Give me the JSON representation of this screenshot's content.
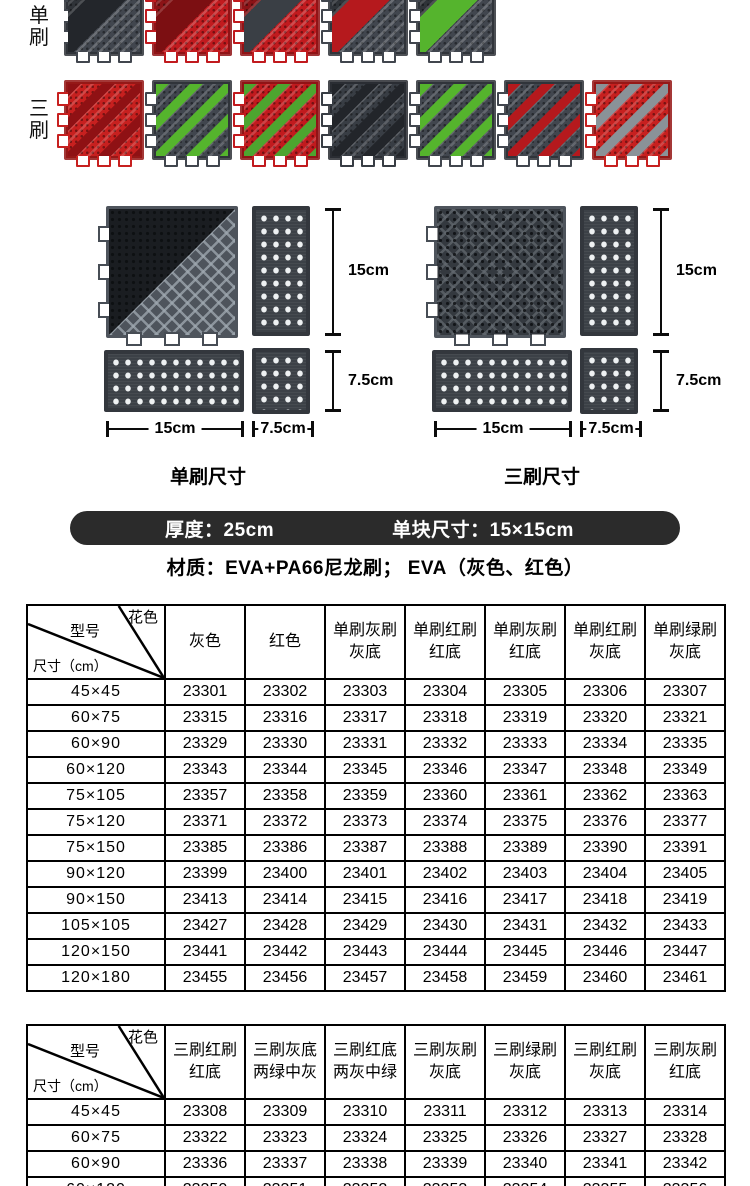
{
  "product_rows": {
    "row1_label": "单刷",
    "row2_label": "三刷",
    "row1_tiles": [
      {
        "name": "tile-single-gray-brush-gray-base",
        "base": "#41464e",
        "brush": "#23262b",
        "style": "single"
      },
      {
        "name": "tile-single-red-brush-red-base",
        "base": "#c11a1e",
        "brush": "#7c0f12",
        "style": "single"
      },
      {
        "name": "tile-single-gray-brush-red-base",
        "base": "#c11a1e",
        "brush": "#3a3f45",
        "style": "single"
      },
      {
        "name": "tile-single-red-brush-gray-base",
        "base": "#41464e",
        "brush": "#b5191d",
        "style": "single"
      },
      {
        "name": "tile-single-green-brush-gray-base",
        "base": "#41464e",
        "brush": "#55b42d",
        "style": "single"
      }
    ],
    "row2_tiles": [
      {
        "name": "tile-triple-red-brush-red-base",
        "base": "#c7201f",
        "brush": "#8f1114",
        "style": "multi"
      },
      {
        "name": "tile-triple-gray-base-two-green",
        "base": "#41464e",
        "brush": "#55b42d",
        "style": "multi"
      },
      {
        "name": "tile-triple-red-base-two-gray-mid-green",
        "base": "#c11a1e",
        "brush": "#4da52f",
        "style": "multi"
      },
      {
        "name": "tile-triple-gray-brush-gray-base",
        "base": "#383d44",
        "brush": "#22252a",
        "style": "multi"
      },
      {
        "name": "tile-triple-green-brush-gray-base",
        "base": "#41464e",
        "brush": "#55b42d",
        "style": "multi"
      },
      {
        "name": "tile-triple-red-brush-gray-base",
        "base": "#41464e",
        "brush": "#b5191d",
        "style": "multi"
      },
      {
        "name": "tile-triple-gray-brush-red-base",
        "base": "#c7201f",
        "brush": "#8a9298",
        "style": "multi"
      }
    ]
  },
  "diagrams": {
    "d15": "15cm",
    "d75": "7.5cm",
    "left_caption": "单刷尺寸",
    "right_caption": "三刷尺寸"
  },
  "spec_bar": {
    "thickness": "厚度：25cm",
    "unit_size": "单块尺寸：15×15cm",
    "bg": "#2b2b2b"
  },
  "material_line": "材质：EVA+PA66尼龙刷； EVA（灰色、红色）",
  "tables": [
    {
      "name": "single-brush-code-table",
      "corner": {
        "top_right": "花色",
        "middle": "型号",
        "bottom_left": "尺寸（cm）"
      },
      "columns": [
        [
          "灰色"
        ],
        [
          "红色"
        ],
        [
          "单刷灰刷",
          "灰底"
        ],
        [
          "单刷红刷",
          "红底"
        ],
        [
          "单刷灰刷",
          "红底"
        ],
        [
          "单刷红刷",
          "灰底"
        ],
        [
          "单刷绿刷",
          "灰底"
        ]
      ],
      "rows": [
        {
          "size": "45×45",
          "codes": [
            "23301",
            "23302",
            "23303",
            "23304",
            "23305",
            "23306",
            "23307"
          ]
        },
        {
          "size": "60×75",
          "codes": [
            "23315",
            "23316",
            "23317",
            "23318",
            "23319",
            "23320",
            "23321"
          ]
        },
        {
          "size": "60×90",
          "codes": [
            "23329",
            "23330",
            "23331",
            "23332",
            "23333",
            "23334",
            "23335"
          ]
        },
        {
          "size": "60×120",
          "codes": [
            "23343",
            "23344",
            "23345",
            "23346",
            "23347",
            "23348",
            "23349"
          ]
        },
        {
          "size": "75×105",
          "codes": [
            "23357",
            "23358",
            "23359",
            "23360",
            "23361",
            "23362",
            "23363"
          ]
        },
        {
          "size": "75×120",
          "codes": [
            "23371",
            "23372",
            "23373",
            "23374",
            "23375",
            "23376",
            "23377"
          ]
        },
        {
          "size": "75×150",
          "codes": [
            "23385",
            "23386",
            "23387",
            "23388",
            "23389",
            "23390",
            "23391"
          ]
        },
        {
          "size": "90×120",
          "codes": [
            "23399",
            "23400",
            "23401",
            "23402",
            "23403",
            "23404",
            "23405"
          ]
        },
        {
          "size": "90×150",
          "codes": [
            "23413",
            "23414",
            "23415",
            "23416",
            "23417",
            "23418",
            "23419"
          ]
        },
        {
          "size": "105×105",
          "codes": [
            "23427",
            "23428",
            "23429",
            "23430",
            "23431",
            "23432",
            "23433"
          ]
        },
        {
          "size": "120×150",
          "codes": [
            "23441",
            "23442",
            "23443",
            "23444",
            "23445",
            "23446",
            "23447"
          ]
        },
        {
          "size": "120×180",
          "codes": [
            "23455",
            "23456",
            "23457",
            "23458",
            "23459",
            "23460",
            "23461"
          ]
        }
      ]
    },
    {
      "name": "triple-brush-code-table",
      "corner": {
        "top_right": "花色",
        "middle": "型号",
        "bottom_left": "尺寸（cm）"
      },
      "columns": [
        [
          "三刷红刷",
          "红底"
        ],
        [
          "三刷灰底",
          "两绿中灰"
        ],
        [
          "三刷红底",
          "两灰中绿"
        ],
        [
          "三刷灰刷",
          "灰底"
        ],
        [
          "三刷绿刷",
          "灰底"
        ],
        [
          "三刷红刷",
          "灰底"
        ],
        [
          "三刷灰刷",
          "红底"
        ]
      ],
      "rows": [
        {
          "size": "45×45",
          "codes": [
            "23308",
            "23309",
            "23310",
            "23311",
            "23312",
            "23313",
            "23314"
          ]
        },
        {
          "size": "60×75",
          "codes": [
            "23322",
            "23323",
            "23324",
            "23325",
            "23326",
            "23327",
            "23328"
          ]
        },
        {
          "size": "60×90",
          "codes": [
            "23336",
            "23337",
            "23338",
            "23339",
            "23340",
            "23341",
            "23342"
          ]
        },
        {
          "size": "60×120",
          "codes": [
            "23350",
            "23351",
            "23352",
            "23353",
            "23354",
            "23355",
            "23356"
          ]
        }
      ]
    }
  ]
}
